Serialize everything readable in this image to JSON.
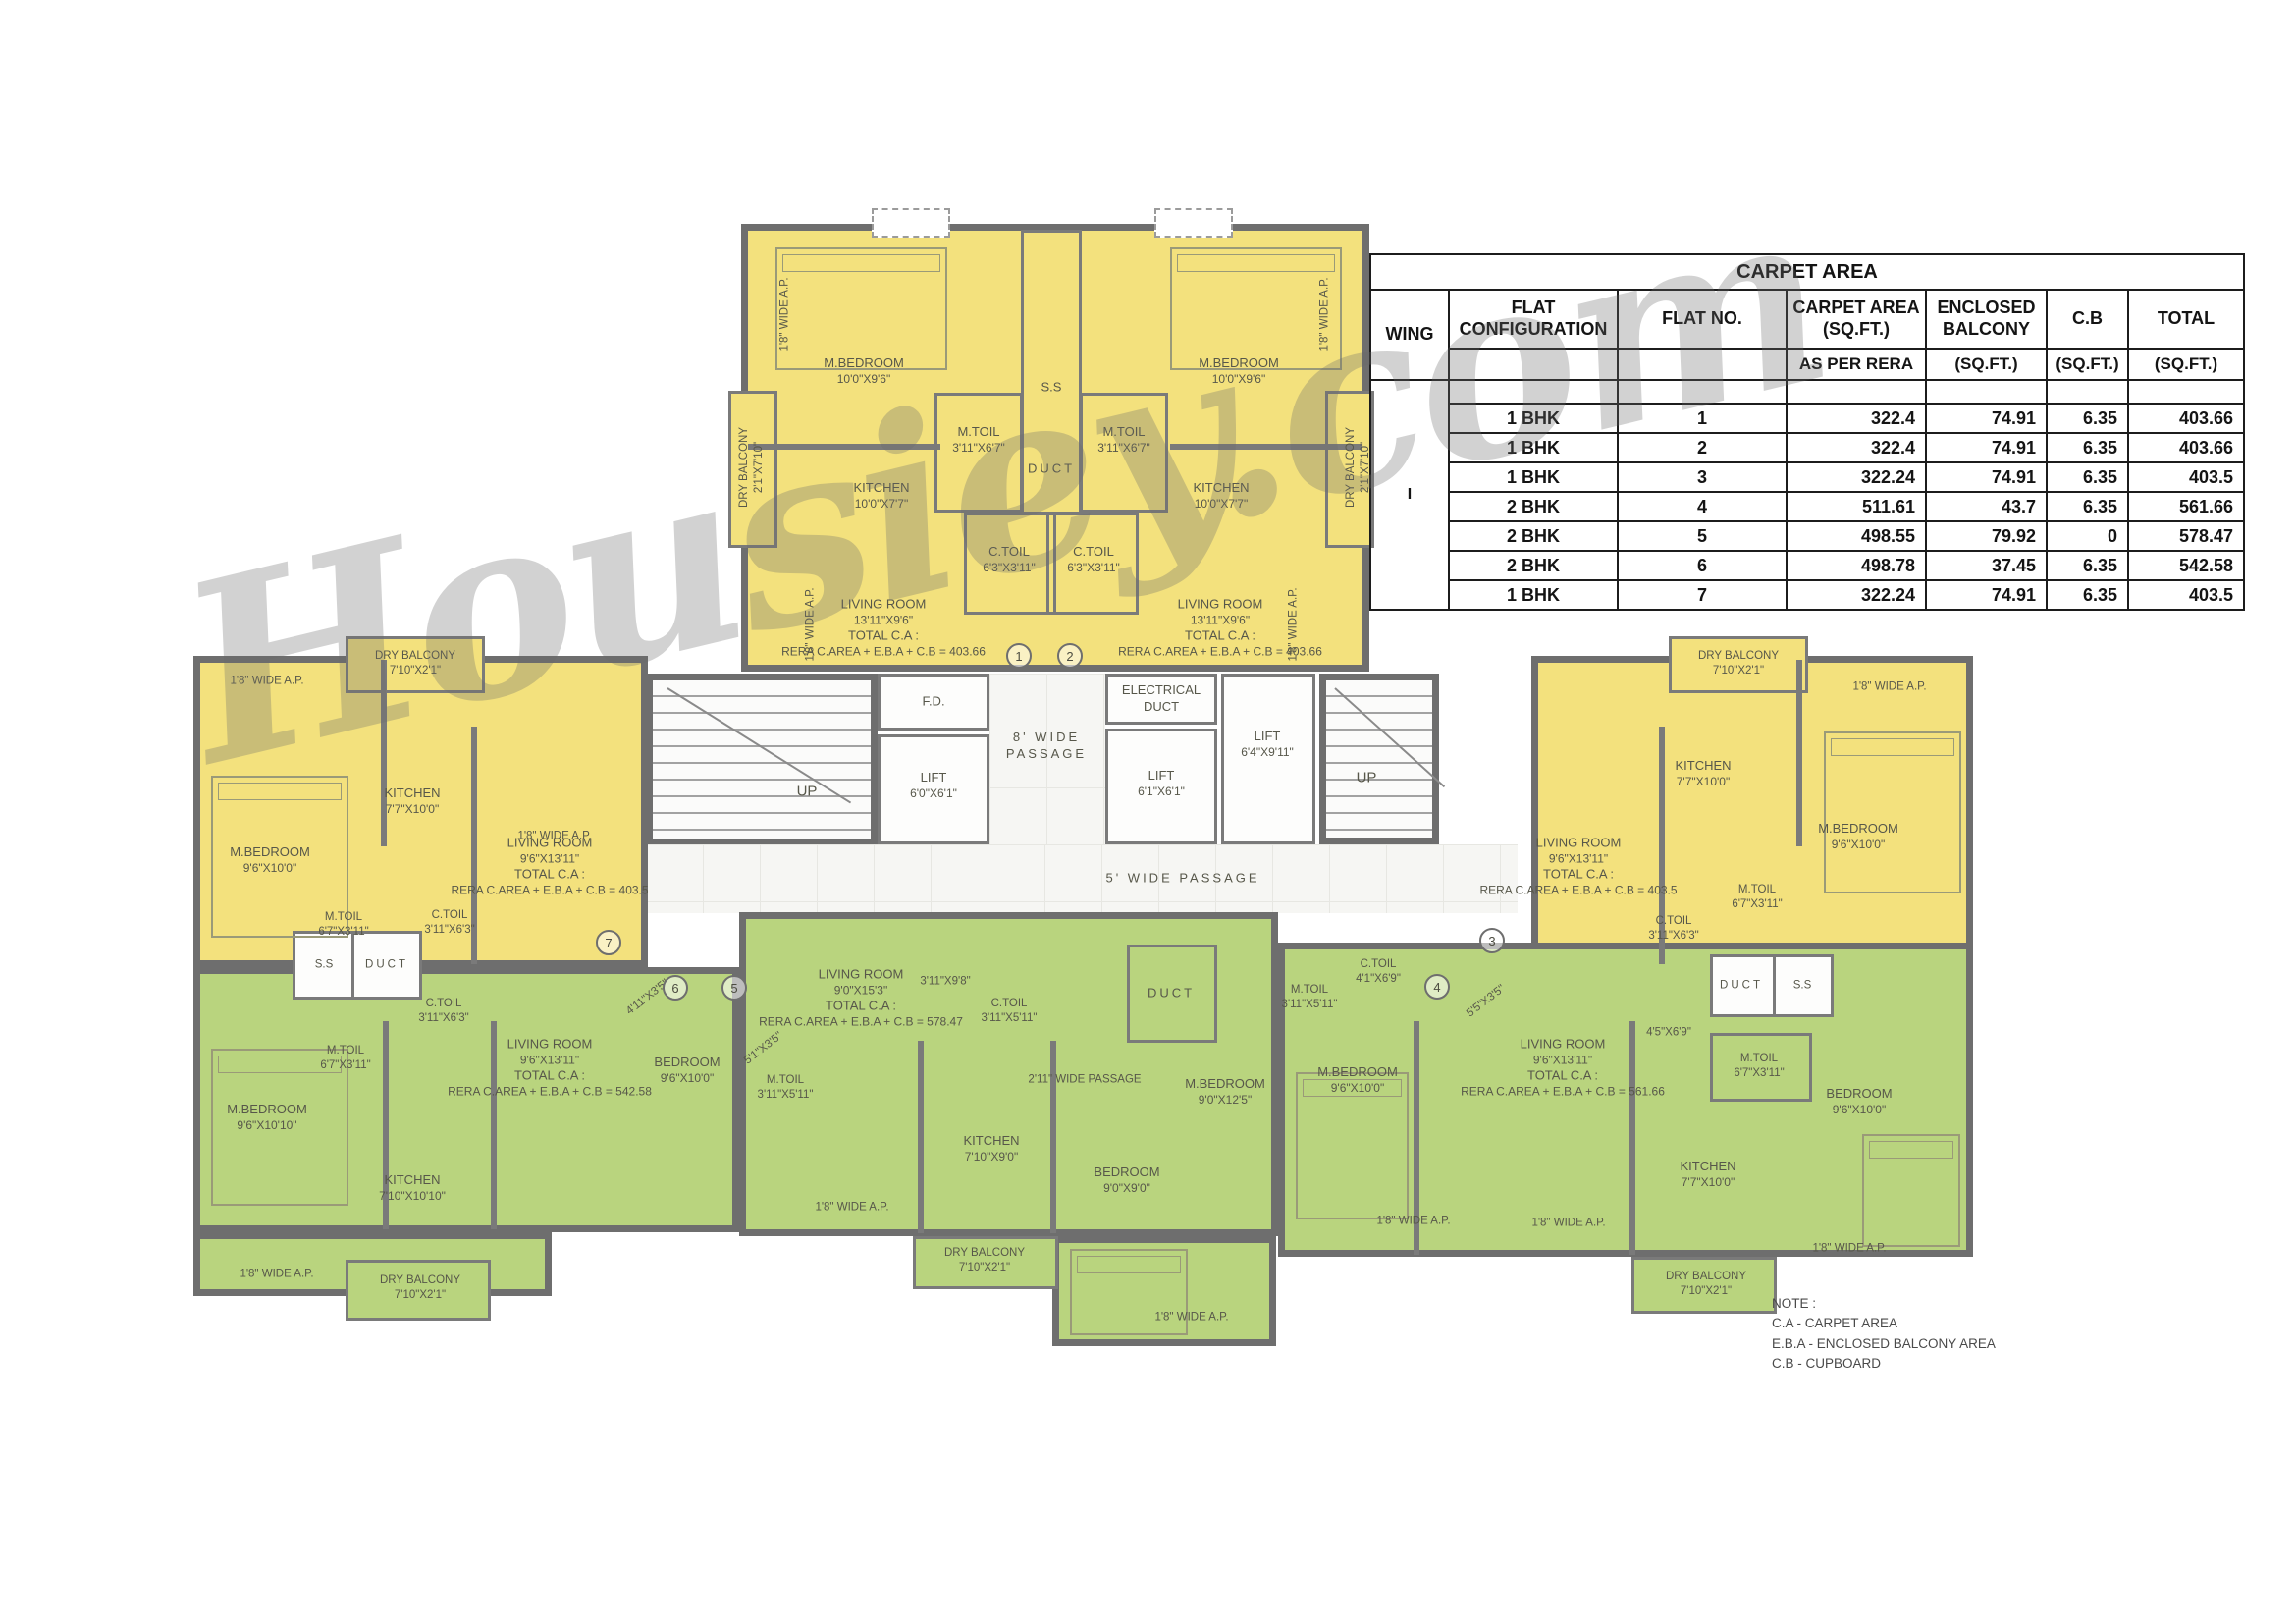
{
  "watermark": "Housiey.com",
  "labels": {
    "up": "UP",
    "duct": "DUCT",
    "ss": "S.S",
    "wide_ap": "1'8\" WIDE A.P.",
    "fd": "F.D.",
    "electrical_1": "ELECTRICAL",
    "electrical_2": "DUCT",
    "passage8_1": "8' WIDE",
    "passage8_2": "PASSAGE",
    "passage5": "5' WIDE PASSAGE",
    "passage211": "2'11\" WIDE PASSAGE"
  },
  "lifts": {
    "lift1": {
      "n": "LIFT",
      "d": "6'0\"X6'1\""
    },
    "lift2": {
      "n": "LIFT",
      "d": "6'1\"X6'1\""
    },
    "lift3": {
      "n": "LIFT",
      "d": "6'4\"X9'11\""
    }
  },
  "flats": {
    "f1": {
      "no": "1",
      "living": [
        "LIVING ROOM",
        "13'11\"X9'6\"",
        "TOTAL C.A :",
        "RERA C.AREA + E.B.A + C.B = 403.66"
      ],
      "mbedroom": {
        "n": "M.BEDROOM",
        "d": "10'0\"X9'6\""
      },
      "mtoil": {
        "n": "M.TOIL",
        "d": "3'11\"X6'7\""
      },
      "kitchen": {
        "n": "KITCHEN",
        "d": "10'0\"X7'7\""
      },
      "ctoil": {
        "n": "C.TOIL",
        "d": "6'3\"X3'11\""
      },
      "balcony": {
        "n": "DRY BALCONY",
        "d": "2'1\"X7'10\""
      }
    },
    "f2": {
      "no": "2",
      "living": [
        "LIVING ROOM",
        "13'11\"X9'6\"",
        "TOTAL C.A :",
        "RERA C.AREA + E.B.A + C.B = 403.66"
      ],
      "mbedroom": {
        "n": "M.BEDROOM",
        "d": "10'0\"X9'6\""
      },
      "mtoil": {
        "n": "M.TOIL",
        "d": "3'11\"X6'7\""
      },
      "kitchen": {
        "n": "KITCHEN",
        "d": "10'0\"X7'7\""
      },
      "ctoil": {
        "n": "C.TOIL",
        "d": "6'3\"X3'11\""
      },
      "balcony": {
        "n": "DRY BALCONY",
        "d": "2'1\"X7'10\""
      }
    },
    "f3": {
      "no": "3",
      "living": [
        "LIVING ROOM",
        "9'6\"X13'11\"",
        "TOTAL C.A :",
        "RERA C.AREA + E.B.A + C.B = 403.5"
      ],
      "mbedroom": {
        "n": "M.BEDROOM",
        "d": "9'6\"X10'0\""
      },
      "mtoil": {
        "n": "M.TOIL",
        "d": "6'7\"X3'11\""
      },
      "kitchen": {
        "n": "KITCHEN",
        "d": "7'7\"X10'0\""
      },
      "ctoil": {
        "n": "C.TOIL",
        "d": "3'11\"X6'3\""
      },
      "balcony": {
        "n": "DRY BALCONY",
        "d": "7'10\"X2'1\""
      }
    },
    "f4": {
      "no": "4",
      "living": [
        "LIVING ROOM",
        "9'6\"X13'11\"",
        "TOTAL C.A :",
        "RERA C.AREA + E.B.A + C.B = 561.66"
      ],
      "mbedroom": {
        "n": "M.BEDROOM",
        "d": "9'6\"X10'0\""
      },
      "bedroom": {
        "n": "BEDROOM",
        "d": "9'6\"X10'0\""
      },
      "mtoil": {
        "n": "M.TOIL",
        "d": "3'11\"X5'11\""
      },
      "mtoil2": {
        "n": "M.TOIL",
        "d": "6'7\"X3'11\""
      },
      "ctoil": {
        "n": "C.TOIL",
        "d": "4'1\"X6'9\""
      },
      "kitchen": {
        "n": "KITCHEN",
        "d": "7'7\"X10'0\""
      },
      "balcony": {
        "n": "DRY BALCONY",
        "d": "7'10\"X2'1\""
      },
      "pass1": "5'5\"X3'5\"",
      "pass2": "4'5\"X6'9\""
    },
    "f5": {
      "no": "5",
      "living": [
        "LIVING ROOM",
        "9'0\"X15'3\"",
        "TOTAL C.A :",
        "RERA C.AREA + E.B.A + C.B = 578.47"
      ],
      "mbedroom": {
        "n": "M.BEDROOM",
        "d": "9'0\"X12'5\""
      },
      "bedroom": {
        "n": "BEDROOM",
        "d": "9'0\"X9'0\""
      },
      "mtoil": {
        "n": "M.TOIL",
        "d": "3'11\"X5'11\""
      },
      "ctoil": {
        "n": "C.TOIL",
        "d": "3'11\"X5'11\""
      },
      "kitchen": {
        "n": "KITCHEN",
        "d": "7'10\"X9'0\""
      },
      "balcony": {
        "n": "DRY BALCONY",
        "d": "7'10\"X2'1\""
      },
      "pass1": "5'1\"X3'5\"",
      "pass2": "3'11\"X9'8\""
    },
    "f6": {
      "no": "6",
      "living": [
        "LIVING ROOM",
        "9'6\"X13'11\"",
        "TOTAL C.A :",
        "RERA C.AREA + E.B.A + C.B = 542.58"
      ],
      "mbedroom": {
        "n": "M.BEDROOM",
        "d": "9'6\"X10'10\""
      },
      "bedroom": {
        "n": "BEDROOM",
        "d": "9'6\"X10'0\""
      },
      "mtoil": {
        "n": "M.TOIL",
        "d": "6'7\"X3'11\""
      },
      "ctoil": {
        "n": "C.TOIL",
        "d": "3'11\"X6'3\""
      },
      "kitchen": {
        "n": "KITCHEN",
        "d": "7'10\"X10'10\""
      },
      "balcony": {
        "n": "DRY BALCONY",
        "d": "7'10\"X2'1\""
      },
      "pass1": "4'11\"X3'5\""
    },
    "f7": {
      "no": "7",
      "living": [
        "LIVING ROOM",
        "9'6\"X13'11\"",
        "TOTAL C.A :",
        "RERA C.AREA + E.B.A + C.B = 403.5"
      ],
      "mbedroom": {
        "n": "M.BEDROOM",
        "d": "9'6\"X10'0\""
      },
      "mtoil": {
        "n": "M.TOIL",
        "d": "6'7\"X3'11\""
      },
      "kitchen": {
        "n": "KITCHEN",
        "d": "7'7\"X10'0\""
      },
      "ctoil": {
        "n": "C.TOIL",
        "d": "3'11\"X6'3\""
      },
      "balcony": {
        "n": "DRY BALCONY",
        "d": "7'10\"X2'1\""
      }
    }
  },
  "table": {
    "title": "CARPET AREA",
    "h": {
      "wing": "WING",
      "config1": "FLAT",
      "config2": "CONFIGURATION",
      "flatno": "FLAT NO.",
      "ca1": "CARPET AREA",
      "ca2": "(SQ.FT.)",
      "eb1": "ENCLOSED",
      "eb2": "BALCONY",
      "cb": "C.B",
      "total": "TOTAL",
      "rera": "AS PER RERA",
      "sqft": "(SQ.FT.)"
    },
    "wing_value": "I",
    "rows": [
      {
        "config": "1 BHK",
        "no": "1",
        "ca": "322.4",
        "eb": "74.91",
        "cb": "6.35",
        "total": "403.66"
      },
      {
        "config": "1 BHK",
        "no": "2",
        "ca": "322.4",
        "eb": "74.91",
        "cb": "6.35",
        "total": "403.66"
      },
      {
        "config": "1 BHK",
        "no": "3",
        "ca": "322.24",
        "eb": "74.91",
        "cb": "6.35",
        "total": "403.5"
      },
      {
        "config": "2 BHK",
        "no": "4",
        "ca": "511.61",
        "eb": "43.7",
        "cb": "6.35",
        "total": "561.66"
      },
      {
        "config": "2 BHK",
        "no": "5",
        "ca": "498.55",
        "eb": "79.92",
        "cb": "0",
        "total": "578.47"
      },
      {
        "config": "2 BHK",
        "no": "6",
        "ca": "498.78",
        "eb": "37.45",
        "cb": "6.35",
        "total": "542.58"
      },
      {
        "config": "1 BHK",
        "no": "7",
        "ca": "322.24",
        "eb": "74.91",
        "cb": "6.35",
        "total": "403.5"
      }
    ]
  },
  "note": {
    "title": "NOTE :",
    "lines": [
      "C.A - CARPET AREA",
      "E.B.A - ENCLOSED BALCONY AREA",
      "C.B - CUPBOARD"
    ]
  }
}
